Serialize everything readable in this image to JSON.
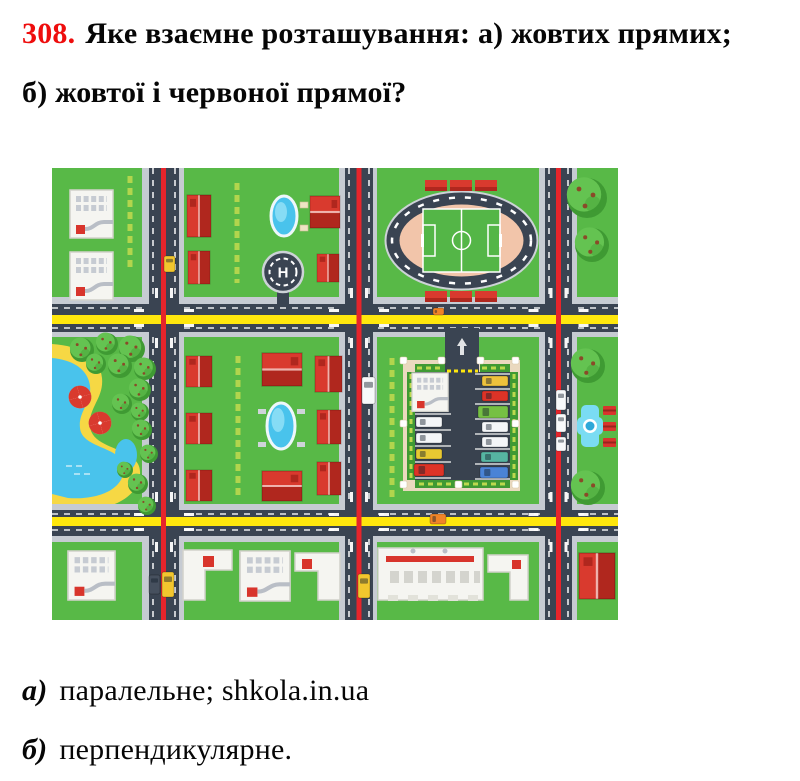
{
  "problem": {
    "number": "308.",
    "number_color": "#ee0d0d",
    "text": "Яке взаємне розташування: а) жовтих прямих; б) жовтої і червоної прямої?"
  },
  "answers": [
    {
      "label": "а)",
      "text": "паралельне; shkola.in.ua"
    },
    {
      "label": "б)",
      "text": "перпендикулярне."
    }
  ],
  "map": {
    "description": "toy-city-playmat-with-yellow-and-red-road-lines",
    "helipad_letter": "H",
    "colors": {
      "grass": "#58b947",
      "road": "#3a4452",
      "sidewalk": "#c6cbd2",
      "lineYellow": "#ffe70d",
      "lineRed": "#e6252b",
      "houseRed": "#d93a2e",
      "houseRedDark": "#b0271e",
      "bldgWhite": "#f5f5f1",
      "bldgBorder": "#d2d2cb",
      "bldgDetail": "#c6cbd2",
      "bldgRed": "#d8352c",
      "water": "#49c3ec",
      "waterLight": "#86dcf5",
      "sand": "#f6d844",
      "trackPink": "#f2c5aa",
      "fieldGreen": "#54b647",
      "treeDark": "#3f9a33",
      "treeLight": "#64c351",
      "berry": "#8a4a28",
      "lotFrame": "#ead9bf",
      "lotInner": "#39424f",
      "hedge": "#3f9a33",
      "stripYellow": "#bcd94e",
      "fountain": "#7adcf3",
      "fountainDeep": "#2ea8d8",
      "benchRed": "#d8352c"
    },
    "red_houses": [
      [
        135,
        27,
        24,
        42,
        0
      ],
      [
        136,
        83,
        22,
        33,
        0
      ],
      [
        258,
        28,
        30,
        32,
        1
      ],
      [
        265,
        86,
        22,
        28,
        0
      ],
      [
        134,
        188,
        26,
        31,
        0
      ],
      [
        134,
        245,
        26,
        31,
        0
      ],
      [
        134,
        302,
        26,
        31,
        0
      ],
      [
        210,
        185,
        40,
        33,
        1
      ],
      [
        210,
        303,
        40,
        30,
        1
      ],
      [
        263,
        188,
        27,
        36,
        0
      ],
      [
        265,
        242,
        24,
        34,
        0
      ],
      [
        265,
        294,
        24,
        33,
        0
      ],
      [
        527,
        385,
        36,
        46,
        0
      ]
    ],
    "white_buildings": [
      [
        18,
        22,
        43,
        48
      ],
      [
        18,
        84,
        43,
        48
      ],
      [
        16,
        383,
        47,
        49
      ],
      [
        188,
        383,
        50,
        50
      ]
    ],
    "l_buildings": [
      {
        "x": 131,
        "y": 382,
        "d": "M0 0h49v20h-27v30h-22z",
        "r": [
          20,
          6,
          11,
          11
        ]
      },
      {
        "x": 243,
        "y": 385,
        "d": "M0 0h45v47h-22v-29h-23z",
        "r": [
          7,
          6,
          10,
          10
        ]
      },
      {
        "x": 436,
        "y": 387,
        "d": "M0 0h40v45h-18v-28h-22z",
        "r": [
          24,
          5,
          9,
          9
        ]
      }
    ],
    "trees": [
      [
        535,
        30,
        20
      ],
      [
        540,
        77,
        17
      ],
      [
        536,
        198,
        17
      ],
      [
        536,
        320,
        17
      ],
      [
        30,
        182,
        12
      ],
      [
        55,
        176,
        11
      ],
      [
        80,
        181,
        13
      ],
      [
        44,
        196,
        10
      ],
      [
        68,
        198,
        12
      ],
      [
        93,
        201,
        11
      ],
      [
        88,
        222,
        11
      ],
      [
        70,
        236,
        10
      ],
      [
        88,
        244,
        9
      ],
      [
        90,
        262,
        10
      ],
      [
        97,
        286,
        9
      ],
      [
        73,
        302,
        8
      ],
      [
        86,
        316,
        10
      ],
      [
        95,
        338,
        9
      ]
    ],
    "umbrellas": [
      [
        28,
        229
      ],
      [
        48,
        255
      ]
    ],
    "name_strips": [
      [
        78,
        8,
        100
      ],
      [
        185,
        15,
        115
      ],
      [
        186,
        188,
        330
      ],
      [
        340,
        190,
        330
      ]
    ],
    "bleachers": [
      [
        373,
        12
      ],
      [
        398,
        12
      ],
      [
        423,
        12
      ],
      [
        373,
        123
      ],
      [
        398,
        123
      ],
      [
        423,
        123
      ]
    ],
    "benches": [
      [
        551,
        238
      ],
      [
        551,
        254
      ],
      [
        551,
        270
      ]
    ],
    "posts": [
      [
        348,
        189
      ],
      [
        386,
        189
      ],
      [
        425,
        189
      ],
      [
        460,
        189
      ],
      [
        348,
        252
      ],
      [
        460,
        252
      ],
      [
        348,
        313
      ],
      [
        403,
        313
      ],
      [
        460,
        313
      ]
    ],
    "stall_lines": [
      {
        "x": 363,
        "w": 36,
        "ys": [
          246,
          262,
          278,
          294,
          310
        ]
      },
      {
        "x": 423,
        "w": 35,
        "ys": [
          206,
          221,
          236,
          251,
          266,
          281,
          296,
          311
        ]
      }
    ],
    "parking_cars": [
      [
        364,
        249,
        26,
        10,
        "#f4f6f8"
      ],
      [
        364,
        265,
        26,
        10,
        "#f4f6f8"
      ],
      [
        364,
        281,
        26,
        10,
        "#e8c832"
      ],
      [
        362,
        296,
        30,
        12,
        "#dd3327"
      ],
      [
        430,
        208,
        26,
        10,
        "#eec23c"
      ],
      [
        430,
        223,
        26,
        10,
        "#dd3327"
      ],
      [
        426,
        238,
        30,
        12,
        "#76c043"
      ],
      [
        430,
        254,
        26,
        10,
        "#f4f6f8"
      ],
      [
        430,
        269,
        26,
        10,
        "#f4f6f8"
      ],
      [
        429,
        284,
        27,
        10,
        "#56b4a2"
      ],
      [
        428,
        299,
        28,
        11,
        "#4a83d6"
      ]
    ],
    "road_cars": [
      [
        112,
        88,
        11,
        16,
        "#f2c62e"
      ],
      [
        97,
        407,
        11,
        19,
        "#46505e"
      ],
      [
        110,
        404,
        12,
        25,
        "#f2c62e"
      ],
      [
        306,
        406,
        12,
        24,
        "#f2c62e"
      ],
      [
        310,
        209,
        13,
        27,
        "#f7f9fa"
      ],
      [
        504,
        222,
        10,
        20,
        "#f7f9fa"
      ],
      [
        504,
        246,
        10,
        18,
        "#f7f9fa"
      ],
      [
        504,
        269,
        10,
        14,
        "#f7f9fa"
      ],
      [
        378,
        346,
        16,
        10,
        "#f08428"
      ],
      [
        381,
        140,
        11,
        7,
        "#f08428"
      ]
    ],
    "intersections": [
      [
        112,
        150
      ],
      [
        307,
        150
      ],
      [
        506.5,
        150
      ],
      [
        112,
        354
      ],
      [
        307,
        354
      ],
      [
        506.5,
        354
      ]
    ]
  }
}
